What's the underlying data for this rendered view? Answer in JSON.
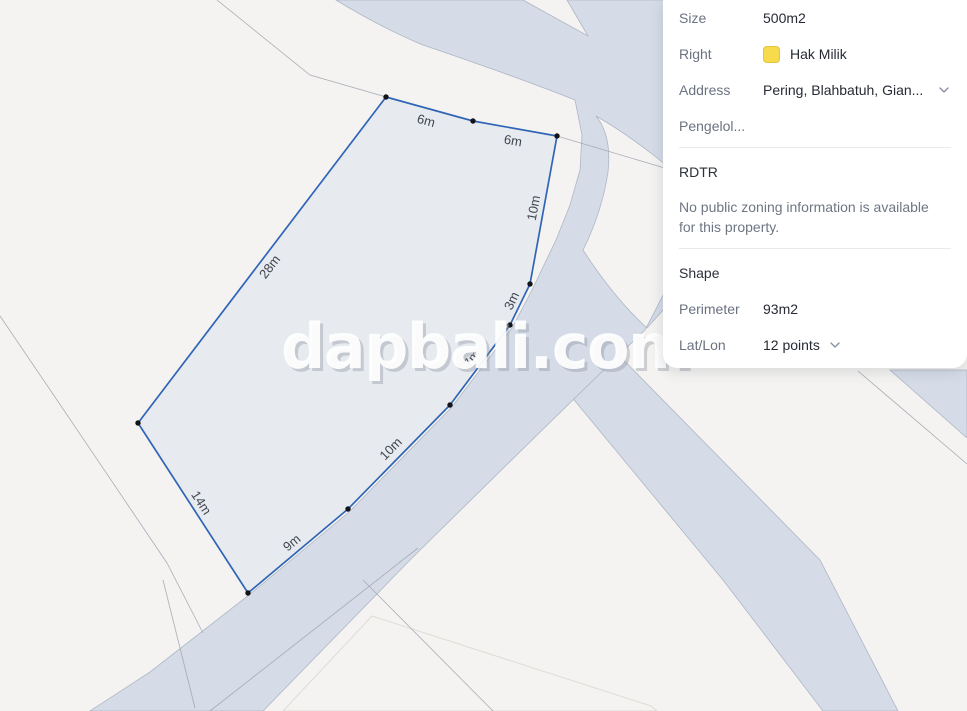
{
  "panel": {
    "rows": {
      "size": {
        "label": "Size",
        "value": "500m2"
      },
      "right": {
        "label": "Right",
        "value": "Hak Milik",
        "swatch_color": "#f8da4d"
      },
      "address": {
        "label": "Address",
        "value": "Pering, Blahbatuh, Gian..."
      },
      "manager": {
        "label": "Pengelol..."
      }
    },
    "rdtr": {
      "title": "RDTR",
      "message_lines": [
        "No public zoning information is available",
        "for this property."
      ]
    },
    "shape": {
      "title": "Shape",
      "perimeter": {
        "label": "Perimeter",
        "value": "93m2"
      },
      "latlon": {
        "label": "Lat/Lon",
        "value": "12 points"
      }
    }
  },
  "map": {
    "watermark": "dapbali.com",
    "edge_labels": [
      "6m",
      "6m",
      "10m",
      "3m",
      "7m",
      "10m",
      "9m",
      "14m",
      "28m"
    ],
    "colors": {
      "parcel_stroke": "#3065b6",
      "road_fill": "#d5dce8",
      "background": "#f4f3f1"
    }
  }
}
